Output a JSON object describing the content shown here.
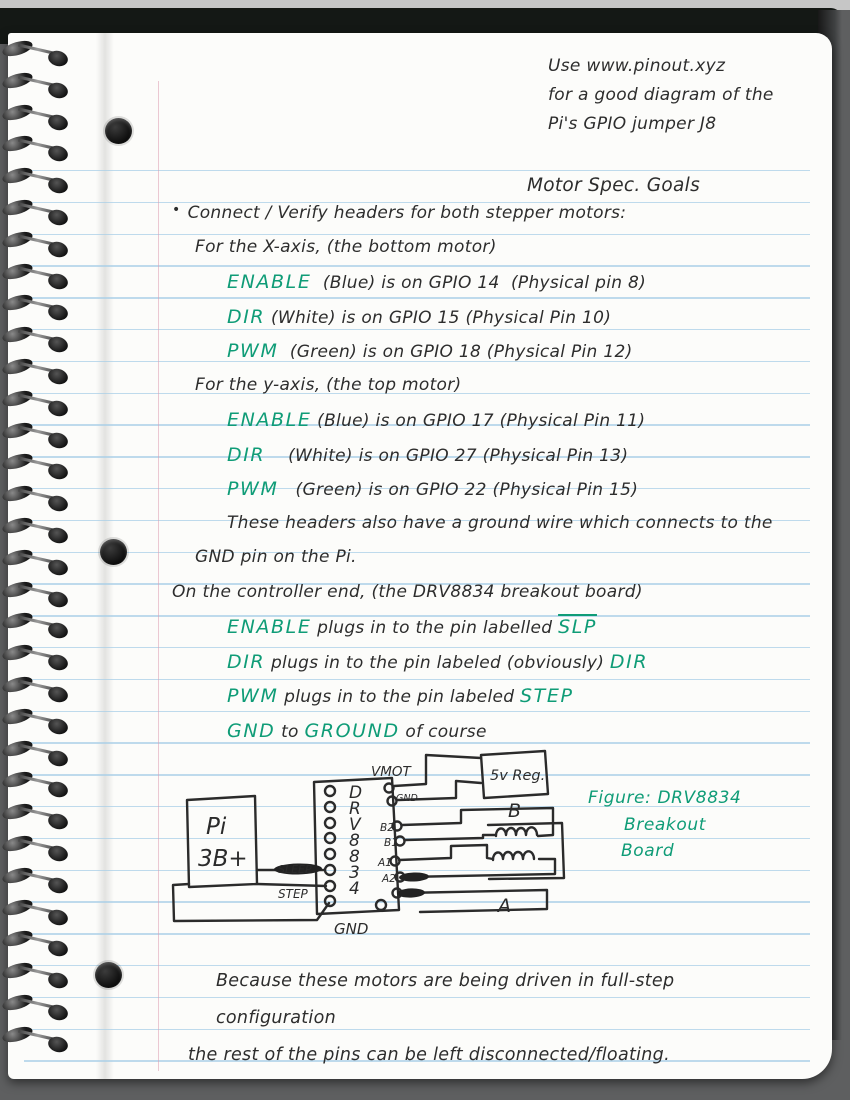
{
  "colors": {
    "ink": "#2d2d2d",
    "green": "#0f9c77",
    "rule_blue": "#a9cfe7",
    "margin_red": "#dd9cb0"
  },
  "corner_note": [
    "Use www.pinout.xyz",
    "for a good diagram of the",
    "Pi's GPIO jumper J8"
  ],
  "title": "Motor Spec. Goals",
  "notes": [
    {
      "indent": 0,
      "bullet": true,
      "seg": [
        {
          "t": "Connect / Verify headers for both stepper motors:"
        }
      ]
    },
    {
      "indent": 1,
      "seg": [
        {
          "t": "For the X-axis, (the bottom motor)"
        }
      ]
    },
    {
      "indent": 2,
      "seg": [
        {
          "t": "ENABLE",
          "green": true
        },
        {
          "t": "  (Blue) is on GPIO 14  (Physical pin 8)"
        }
      ]
    },
    {
      "indent": 2,
      "seg": [
        {
          "t": "DIR",
          "green": true
        },
        {
          "t": " (White) is on GPIO 15 (Physical Pin 10)"
        }
      ]
    },
    {
      "indent": 2,
      "seg": [
        {
          "t": "PWM",
          "green": true
        },
        {
          "t": "  (Green) is on GPIO 18 (Physical Pin 12)"
        }
      ]
    },
    {
      "indent": 1,
      "seg": [
        {
          "t": "For the y-axis, (the top motor)"
        }
      ]
    },
    {
      "indent": 2,
      "seg": [
        {
          "t": "ENABLE",
          "green": true
        },
        {
          "t": " (Blue) is on GPIO 17 (Physical Pin 11)"
        }
      ]
    },
    {
      "indent": 2,
      "seg": [
        {
          "t": "DIR",
          "green": true
        },
        {
          "t": "    (White) is on GPIO 27 (Physical Pin 13)"
        }
      ]
    },
    {
      "indent": 2,
      "seg": [
        {
          "t": "PWM",
          "green": true
        },
        {
          "t": "   (Green) is on GPIO 22 (Physical Pin 15)"
        }
      ]
    },
    {
      "indent": 2,
      "seg": [
        {
          "t": "These headers also have a ground wire which connects to the"
        }
      ]
    },
    {
      "indent": 1,
      "seg": [
        {
          "t": "GND pin on the Pi."
        }
      ]
    },
    {
      "indent": 0,
      "seg": [
        {
          "t": "On the controller end, (the DRV8834 breakout board)"
        }
      ]
    },
    {
      "indent": 2,
      "seg": [
        {
          "t": "ENABLE",
          "green": true
        },
        {
          "t": " plugs in to the pin labelled "
        },
        {
          "t": "SLP",
          "green": true,
          "overline": true
        }
      ]
    },
    {
      "indent": 2,
      "seg": [
        {
          "t": "DIR",
          "green": true
        },
        {
          "t": " plugs in to the pin labeled (obviously) "
        },
        {
          "t": "DIR",
          "green": true
        }
      ]
    },
    {
      "indent": 2,
      "seg": [
        {
          "t": "PWM",
          "green": true
        },
        {
          "t": " plugs in to the pin labeled "
        },
        {
          "t": "STEP",
          "green": true
        }
      ]
    },
    {
      "indent": 2,
      "seg": [
        {
          "t": "GND",
          "green": true
        },
        {
          "t": " to "
        },
        {
          "t": "GROUND",
          "green": true
        },
        {
          "t": " of course"
        }
      ]
    }
  ],
  "diagram": {
    "pi_line1": "Pi",
    "pi_line2": "3B+",
    "chip_letters": [
      "D",
      "R",
      "V",
      "8",
      "8",
      "3",
      "4"
    ],
    "pins": {
      "vmot": "VMOT",
      "gnd_small": "GND",
      "b2": "B2",
      "b1": "B1",
      "a1": "A1",
      "a2": "A2"
    },
    "wires": {
      "sleep": "SLEEP",
      "step": "STEP",
      "gnd": "GND"
    },
    "reg": "5v Reg.",
    "coil_b": "B",
    "coil_a": "A",
    "board_gnd": "GND"
  },
  "figure_caption": [
    "Figure: DRV8834",
    "Breakout",
    "Board"
  ],
  "closing": [
    "Because these motors are being driven in full-step configuration",
    "the rest of the pins can be left disconnected/floating."
  ]
}
